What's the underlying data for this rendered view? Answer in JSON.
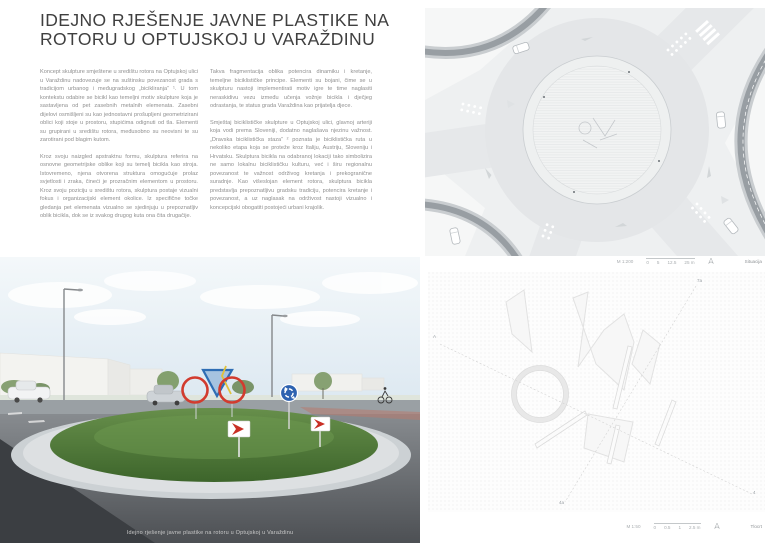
{
  "page": {
    "title_line1": "IDEJNO RJEŠENJE JAVNE PLASTIKE NA",
    "title_line2": "ROTORU U OPTUJSKOJ U VARAŽDINU"
  },
  "columns": {
    "left": [
      "Koncept skulpture smještene u središtu rotora na Optujskoj ulici u Varaždinu nadovezuje se na suštinsku povezanost grada s tradicijom urbanog i međugradskog „bicikliranja“ ¹. U tom kontekstu odabire se bicikl kao temeljni motiv skulpture koja je sastavljena od pet zasebnih metalnih elemenata. Zasebni dijelovi osmišljeni su kao jednostavni prošupljeni geometrizirani oblici koji stoje u prostoru, stupićima odignuti od tla. Elementi su grupirani u središtu rotora, međusobno su neovisni te su zarotirani pod blagim kutom.",
      "Kroz svoju naizgled apstraktnu formu, skulptura referira na osnovne geometrijske oblike koji su temelj bicikla kao stroja. Istovremeno, njena otvorena struktura omogućuje prolaz svjetlosti i zraka, čineći je prozračnim elementom u prostoru. Kroz svoju poziciju u središtu rotora, skulptura postaje vizualni fokus i organizacijski element okolice. Iz specifične točke gledanja pet elemenata vizualno se sjedinjuju u prepoznatljiv oblik bicikla, dok se iz svakog drugog kuta ona čita drugačije."
    ],
    "right": [
      "Takva fragmentacija oblika potencira dinamiku i kretanje, temeljne biciklističke principe. Elementi su bojani, čime se u skulpturu nastoji implementirati motiv igre te time naglasiti neraskidivu vezu između učenja vožnje bicikla i dječjeg odrastanja, te status grada Varaždina kao prijatelja djece.",
      "Smještaj biciklističke skulpture u Optujskoj ulici, glavnoj arteriji koja vodi prema Sloveniji, dodatno naglašava njezinu važnost. „Dravska biciklistička staza“ ² poznata je biciklistička ruta u nekoliko etapa koja se proteže kroz Italiju, Austriju, Sloveniju i Hrvatsku. Skulptura bicikla na odabranoj lokaciji tako simbolizira ne samo lokalnu biciklističku kulturu, već i širu regionalnu povezanost te važnost održivog kretanja i prekogranične suradnje. Kao višeslojan element rotora, skulptura bicikla predstavlja prepoznatljivu gradsku tradiciju, potencira kretanje i povezanost, a uz naglasak na održivost nastoji vizualno i koncepcijski obogatiti postojeći urbani krajolik."
    ]
  },
  "render": {
    "caption": "Idejno rješenje javne plastike na rotoru u Optujskoj u Varaždinu"
  },
  "plan": {
    "scale": "M 1:200",
    "ticks": [
      "0",
      "5",
      "12.5",
      "25 m"
    ],
    "label": "Situacija"
  },
  "sketch": {
    "scale": "M 1:50",
    "ticks": [
      "0",
      "0.5",
      "1",
      "2.5 m"
    ],
    "label": "Tlocrt",
    "view_labels": [
      "A",
      "7a",
      "4a",
      "4"
    ]
  },
  "colors": {
    "wheel_red": "#d23b2e",
    "frame_blue": "#2e6db4",
    "fork_yellow": "#e0c23c",
    "grass_green": "#527c3a",
    "sign_blue": "#2d62b0"
  }
}
